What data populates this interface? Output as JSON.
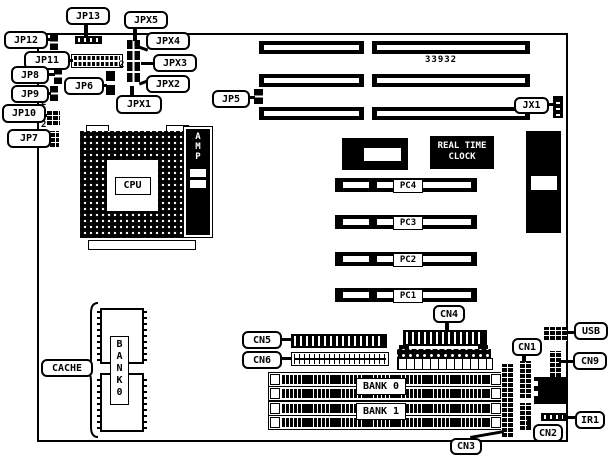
{
  "part_number": "33932",
  "colors": {
    "line": "#000000",
    "background": "#ffffff"
  },
  "callouts": {
    "jp13": "JP13",
    "jpx5": "JPX5",
    "jp12": "JP12",
    "jpx4": "JPX4",
    "jp11": "JP11",
    "jpx3": "JPX3",
    "jp8": "JP8",
    "jp6": "JP6",
    "jpx2": "JPX2",
    "jpx1": "JPX1",
    "jp9": "JP9",
    "jp10": "JP10",
    "jp7": "JP7",
    "jp5": "JP5",
    "jx1": "JX1",
    "cache": "CACHE",
    "cn5": "CN5",
    "cn6": "CN6",
    "cn4": "CN4",
    "cn1": "CN1",
    "usb": "USB",
    "cn9": "CN9",
    "ir1": "IR1",
    "cn2": "CN2",
    "cn3": "CN3"
  },
  "chips": {
    "cpu": "CPU",
    "amp": "AMP",
    "bios": "BIOS",
    "rtc_line1": "REAL TIME",
    "rtc_line2": "CLOCK",
    "kbd": "KBD",
    "bank0_vertical": "BANK0",
    "bank0": "BANK 0",
    "bank1": "BANK 1"
  },
  "slots": {
    "pci": [
      "PC4",
      "PC3",
      "PC2",
      "PC1"
    ]
  },
  "markers": {
    "m1": "2",
    "m2": "2",
    "m3": "2"
  }
}
